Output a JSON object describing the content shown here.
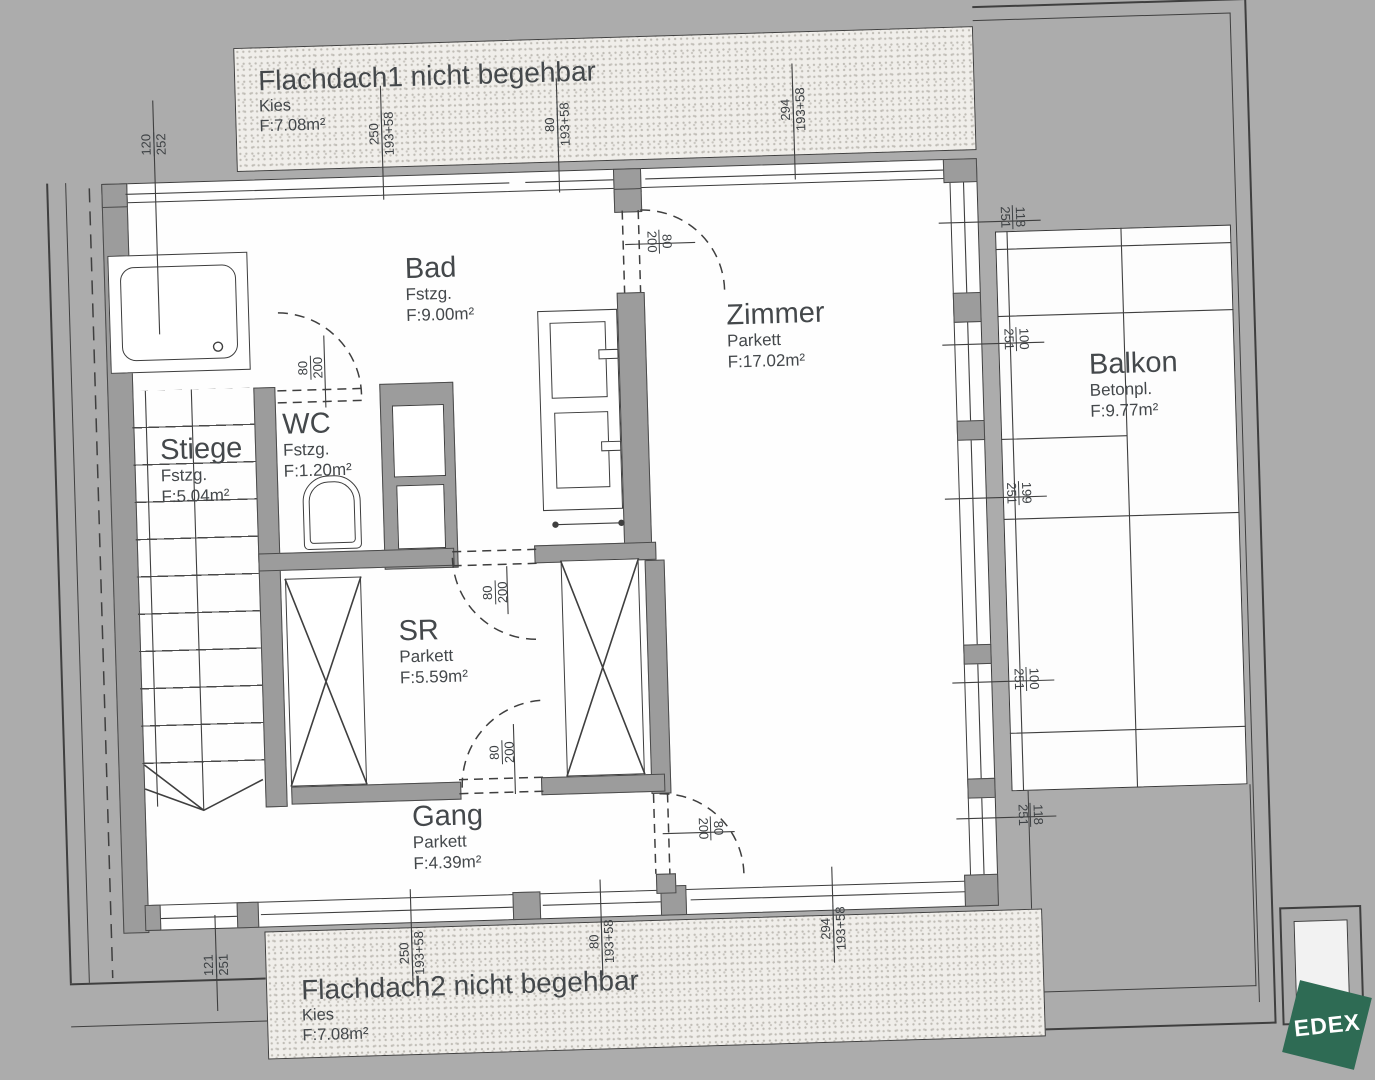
{
  "colors": {
    "background": "#acacac",
    "wall_gray": "#9c9c9c",
    "line_dark": "#3f3f3f",
    "floor_white": "#fefefe",
    "logo_green": "#2e6b54"
  },
  "strips": {
    "f1": {
      "title": "Flachdach1 nicht begehbar",
      "material": "Kies",
      "area": "F:7.08m²"
    },
    "f2": {
      "title": "Flachdach2 nicht begehbar",
      "material": "Kies",
      "area": "F:7.08m²"
    }
  },
  "rooms": [
    {
      "id": "stiege",
      "name": "Stiege",
      "material": "Fstzg.",
      "area": "F:5.04m²"
    },
    {
      "id": "wc",
      "name": "WC",
      "material": "Fstzg.",
      "area": "F:1.20m²"
    },
    {
      "id": "bad",
      "name": "Bad",
      "material": "Fstzg.",
      "area": "F:9.00m²"
    },
    {
      "id": "zimmer",
      "name": "Zimmer",
      "material": "Parkett",
      "area": "F:17.02m²"
    },
    {
      "id": "sr",
      "name": "SR",
      "material": "Parkett",
      "area": "F:5.59m²"
    },
    {
      "id": "gang",
      "name": "Gang",
      "material": "Parkett",
      "area": "F:4.39m²"
    },
    {
      "id": "balkon",
      "name": "Balkon",
      "material": "Betonpl.",
      "area": "F:9.77m²"
    }
  ],
  "dims": [
    {
      "num": "120",
      "den": "252"
    },
    {
      "num": "250",
      "den": "193+58"
    },
    {
      "num": "80",
      "den": "193+58"
    },
    {
      "num": "294",
      "den": "193+58"
    },
    {
      "num": "80",
      "den": "200"
    },
    {
      "num": "80",
      "den": "200"
    },
    {
      "num": "118",
      "den": "251"
    },
    {
      "num": "100",
      "den": "251"
    },
    {
      "num": "199",
      "den": "251"
    },
    {
      "num": "80",
      "den": "200"
    },
    {
      "num": "80",
      "den": "200"
    },
    {
      "num": "80",
      "den": "200"
    },
    {
      "num": "121",
      "den": "251"
    },
    {
      "num": "250",
      "den": "193+58"
    },
    {
      "num": "80",
      "den": "193+58"
    },
    {
      "num": "294",
      "den": "193+58"
    },
    {
      "num": "100",
      "den": "251"
    },
    {
      "num": "118",
      "den": "251"
    }
  ],
  "logo": {
    "text": "EDEX"
  }
}
